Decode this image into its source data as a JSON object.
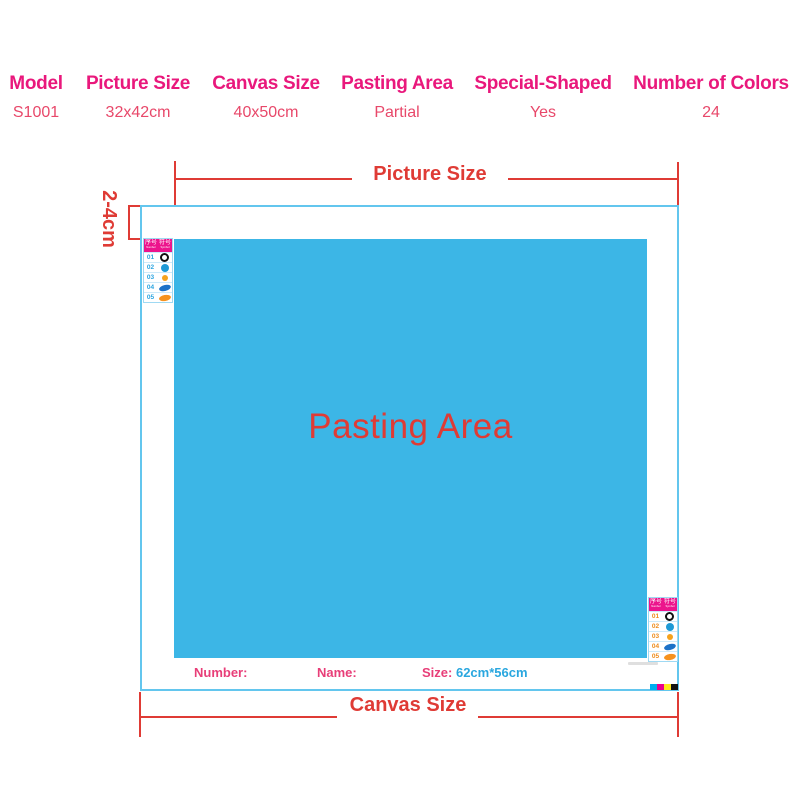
{
  "spec_table": {
    "header_color": "#e9187c",
    "value_color": "#e8486a",
    "columns": [
      {
        "header": "Model",
        "value": "S1001"
      },
      {
        "header": "Picture Size",
        "value": "32x42cm"
      },
      {
        "header": "Canvas Size",
        "value": "40x50cm"
      },
      {
        "header": "Pasting Area",
        "value": "Partial"
      },
      {
        "header": "Special-Shaped",
        "value": "Yes"
      },
      {
        "header": "Number of Colors",
        "value": "24"
      }
    ]
  },
  "diagram": {
    "picture_size_label": "Picture Size",
    "canvas_size_label": "Canvas Size",
    "margin_label": "2-4cm",
    "pasting_area_label": "Pasting Area",
    "footer": {
      "number_label": "Number:",
      "name_label": "Name:",
      "size_label": "Size:",
      "size_value": "62cm*56cm"
    },
    "colors": {
      "dimension_red": "#df3b35",
      "canvas_border": "#63c6ee",
      "pasting_fill": "#3cb6e6",
      "size_value_blue": "#2aa7df",
      "footer_pink": "#e83e78"
    },
    "print_marks": [
      "#00aeef",
      "#ec008c",
      "#ffe81a",
      "#131313"
    ]
  },
  "legend_sticker": {
    "header_color": "#ec148c",
    "header_cells": [
      {
        "cn": "序号",
        "en": "Number"
      },
      {
        "cn": "符号",
        "en": "Symbol"
      }
    ],
    "rows": [
      {
        "num": "01",
        "symbol": "ring-black"
      },
      {
        "num": "02",
        "symbol": "circle-blue"
      },
      {
        "num": "03",
        "symbol": "dot-orange"
      },
      {
        "num": "04",
        "symbol": "oval-blue"
      },
      {
        "num": "05",
        "symbol": "oval-orange"
      }
    ],
    "instances": [
      {
        "position": "top-left",
        "num_color": "#2aa4e0"
      },
      {
        "position": "bottom-right",
        "num_color": "#ee8c1c"
      }
    ]
  }
}
